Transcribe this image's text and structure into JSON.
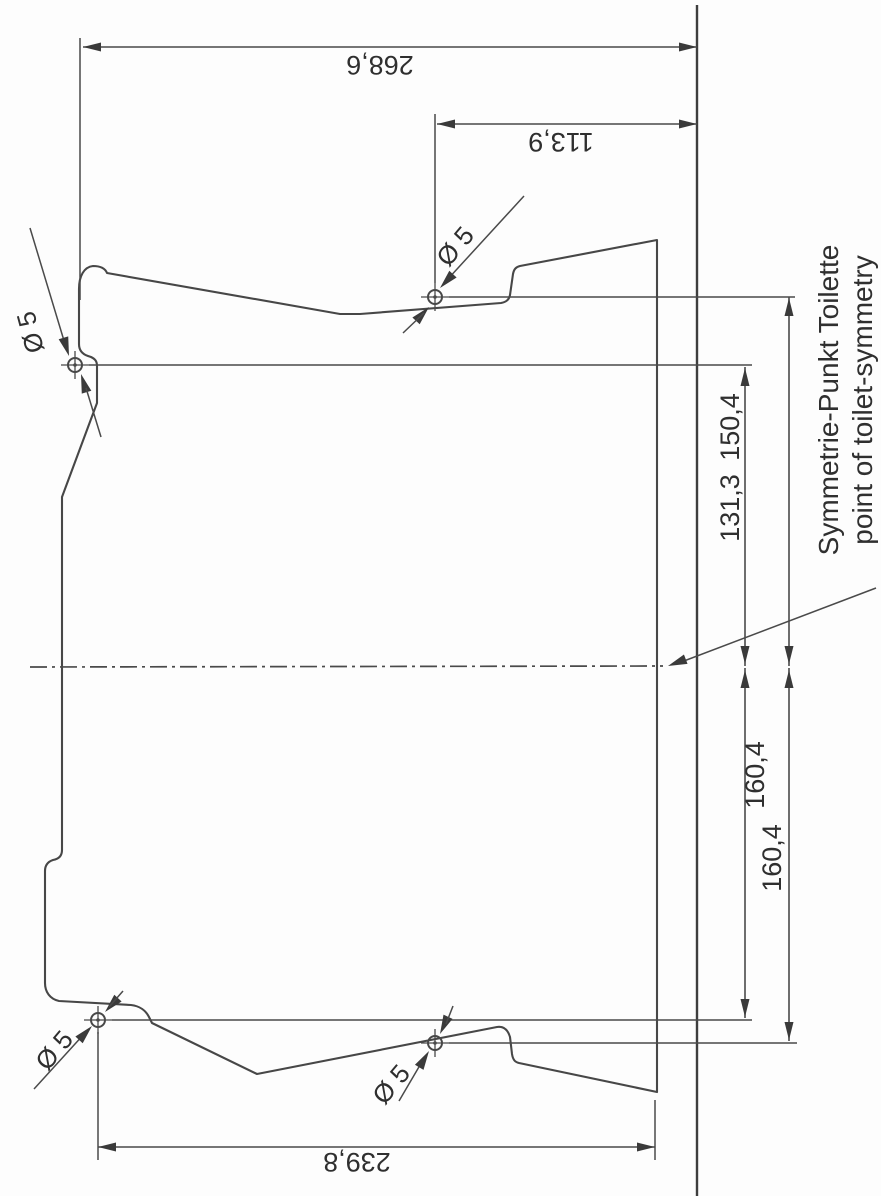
{
  "drawing": {
    "dimensions": {
      "overall": "268,6",
      "hole_to_wall": "113,9",
      "bottom_span": "239,8",
      "upper_inner": "131,3",
      "upper_outer": "150,4",
      "lower_inner": "160,4",
      "lower_outer": "160,4"
    },
    "hole_callouts": [
      "Ø 5",
      "Ø 5",
      "Ø 5",
      "Ø 5"
    ],
    "symmetry_note_de": "Symmetrie-Punkt Toilette",
    "symmetry_note_en": "point of toilet-symmetry"
  },
  "colors": {
    "line": "#474747",
    "thin_line": "#4a4a4a",
    "reference_line": "#3e3e3e",
    "text": "#2f2f2f",
    "background": "#fdfdfd"
  }
}
